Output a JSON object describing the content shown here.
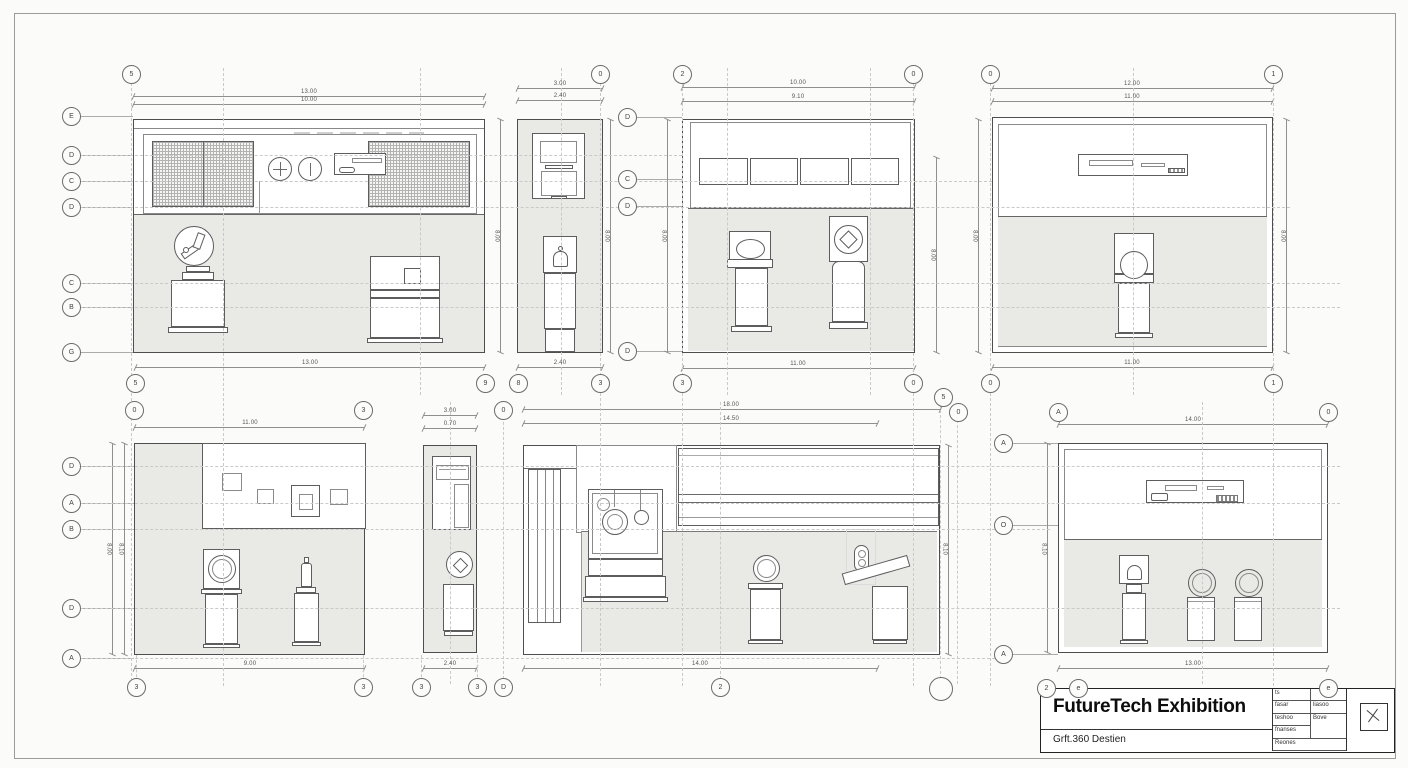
{
  "sheet": {
    "background": "#fbfbf9",
    "border_color": "#9b9b9b",
    "paper_color": "#ffffff",
    "shade_color": "#e9e9e6",
    "line_color": "#4e4e4e"
  },
  "title_block": {
    "title": "FutureTech Exhibition",
    "subtitle": "Grft.360 Destien",
    "cells": {
      "r1a": "ts",
      "r2a": "fasar",
      "r2b": "liasoo",
      "r3a": "teshoo",
      "r3b": "Bove",
      "r4a": "fnanses",
      "r5a": "Reones"
    }
  },
  "bubbles": [
    "5",
    "0",
    "2",
    "0",
    "0",
    "1",
    "E",
    "D",
    "C",
    "D",
    "C",
    "B",
    "G",
    "D",
    "C",
    "D",
    "D",
    "5",
    "9",
    "8",
    "3",
    "3",
    "0",
    "0",
    "1",
    "0",
    "3",
    "0",
    "5",
    "0",
    "A",
    "0",
    "A",
    "O",
    "A",
    "D",
    "A",
    "B",
    "D",
    "A",
    "3",
    "3",
    "3",
    "3",
    "D",
    "2",
    "2",
    "e",
    "e"
  ],
  "dims": [
    "13.00",
    "10.00",
    "13.00",
    "8.00",
    "3.00",
    "2.40",
    "2.40",
    "8.00",
    "8.00",
    "10.00",
    "9.10",
    "11.00",
    "8.00",
    "12.00",
    "11.00",
    "11.00",
    "8.00",
    "8.00",
    "11.00",
    "9.00",
    "8.00",
    "8.10",
    "3.00",
    "0.70",
    "2.40",
    "18.00",
    "14.50",
    "14.00",
    "8.10",
    "14.00",
    "13.00",
    "8.10"
  ]
}
